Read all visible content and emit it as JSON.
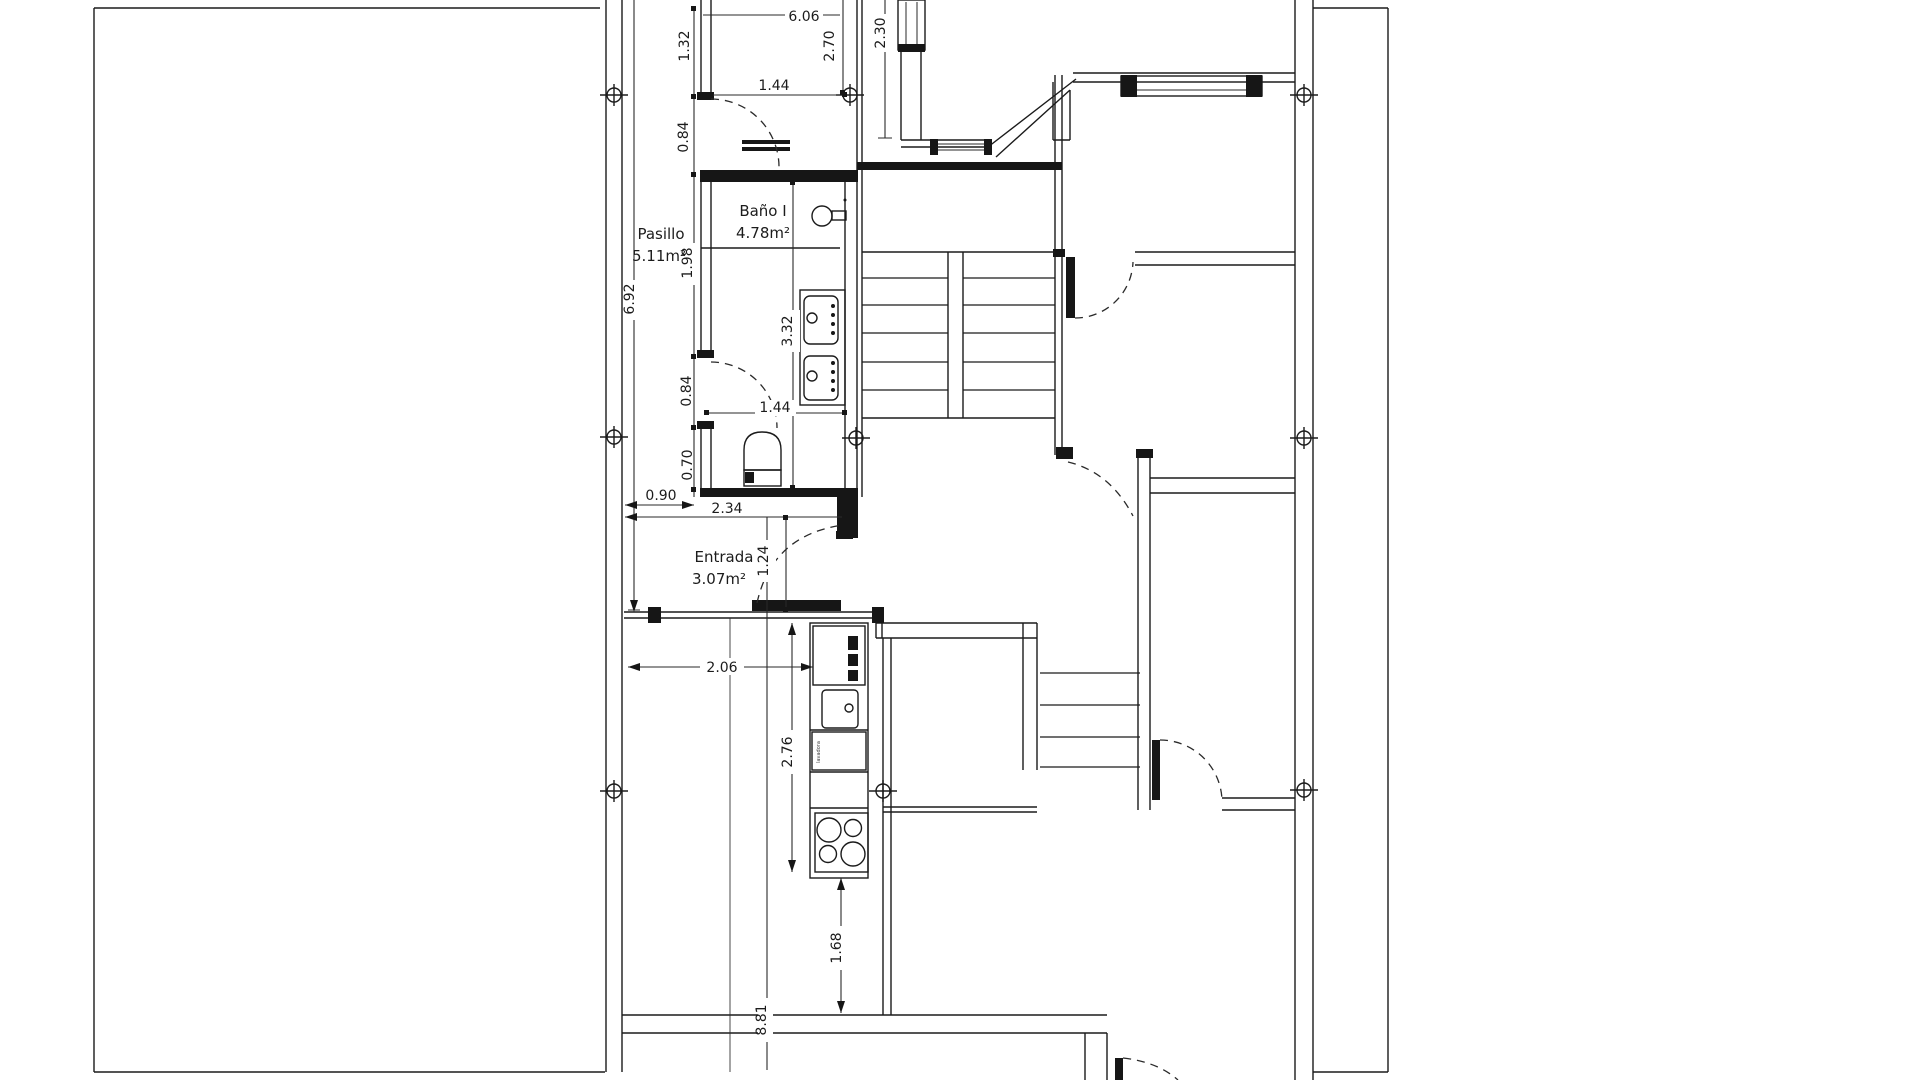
{
  "drawing": {
    "type": "architectural-floor-plan",
    "units": "m",
    "line_color": "#1b1b1b",
    "background": "#ffffff"
  },
  "rooms": [
    {
      "name": "Pasillo",
      "area": "5.11m²"
    },
    {
      "name": "Baño I",
      "area": "4.78m²"
    },
    {
      "name": "Entrada",
      "area": "3.07m²"
    }
  ],
  "dimensions": {
    "d606": "6.06",
    "d132": "1.32",
    "d270": "2.70",
    "d230": "2.30",
    "d144_top": "1.44",
    "d084_top": "0.84",
    "d692": "6.92",
    "d198": "1.98",
    "d332": "3.32",
    "d084_mid": "0.84",
    "d144_mid": "1.44",
    "d070": "0.70",
    "d090": "0.90",
    "d234": "2.34",
    "d124": "1.24",
    "d206": "2.06",
    "d276": "2.76",
    "d168": "1.68",
    "d881": "8.81"
  },
  "appliance_label": "lavadora"
}
